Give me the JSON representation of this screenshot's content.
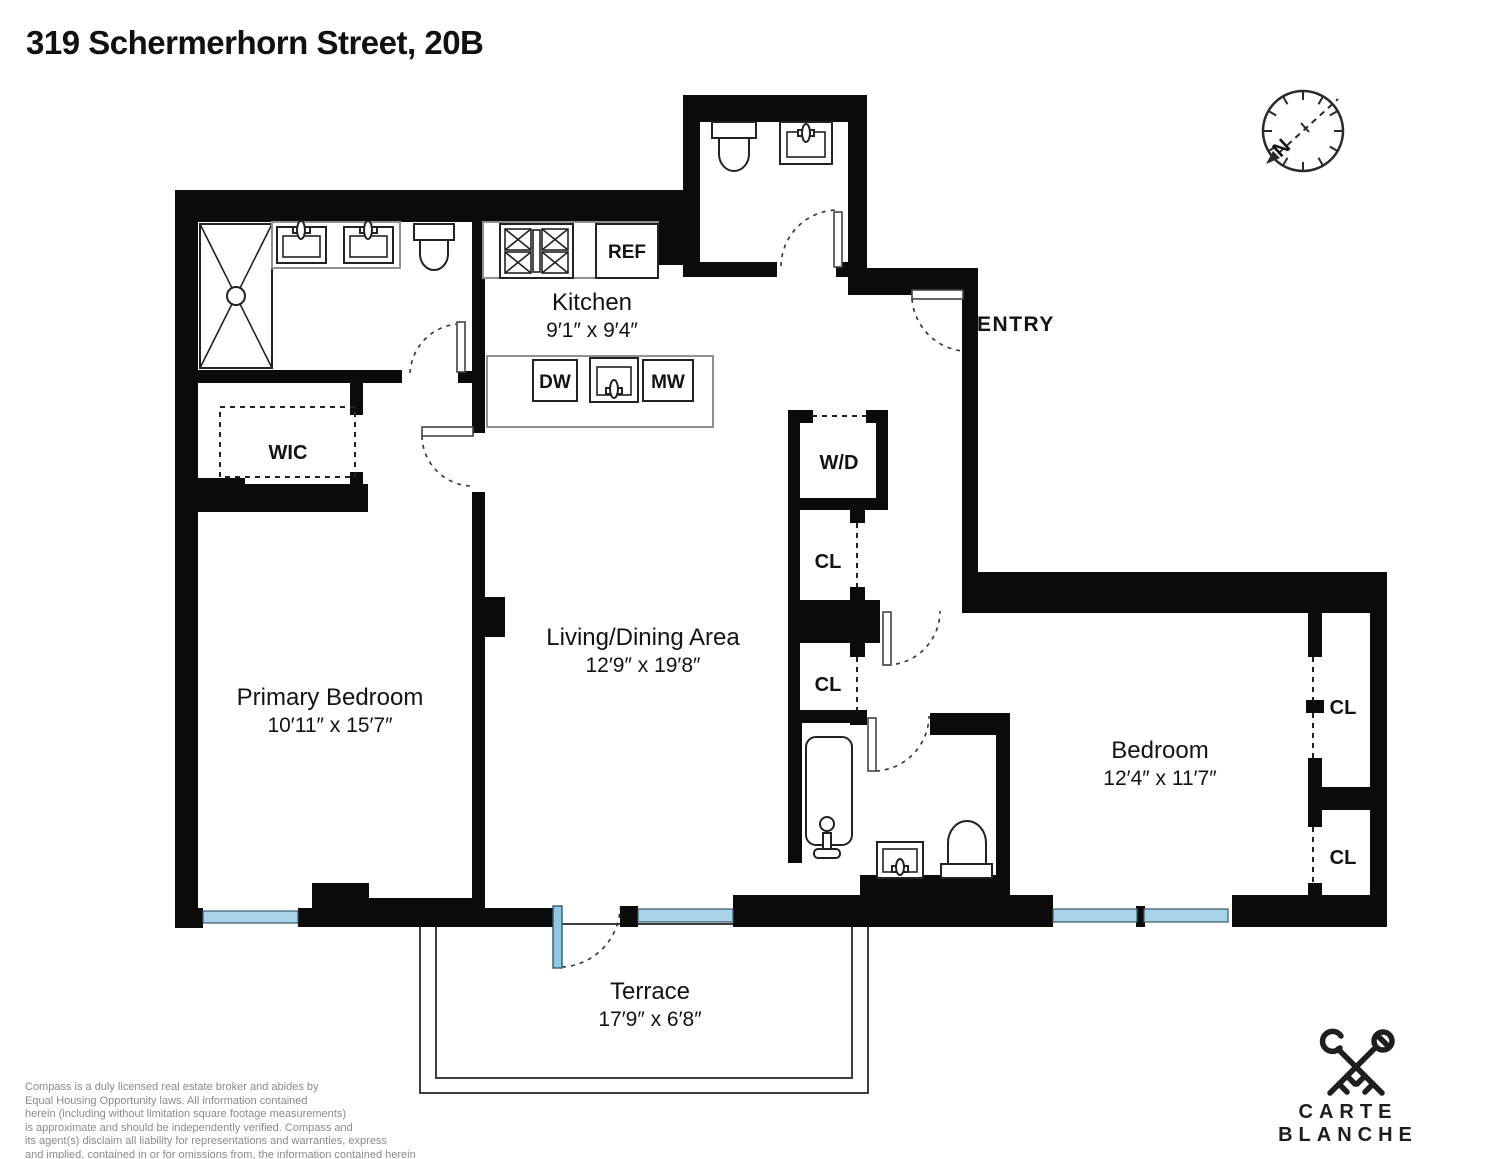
{
  "title": "319 Schermerhorn Street, 20B",
  "rooms": {
    "kitchen": {
      "name": "Kitchen",
      "dims": "9′1″ x 9′4″"
    },
    "living": {
      "name": "Living/Dining Area",
      "dims": "12′9″ x 19′8″"
    },
    "primary_bedroom": {
      "name": "Primary Bedroom",
      "dims": "10′11″ x 15′7″"
    },
    "bedroom": {
      "name": "Bedroom",
      "dims": "12′4″ x 11′7″"
    },
    "terrace": {
      "name": "Terrace",
      "dims": "17′9″ x 6′8″"
    },
    "entry": {
      "name": "ENTRY"
    },
    "wic": {
      "name": "WIC"
    },
    "washer_dryer": {
      "name": "W/D"
    }
  },
  "closets": [
    "CL",
    "CL",
    "CL",
    "CL"
  ],
  "appliances": {
    "refrigerator": "REF",
    "dishwasher": "DW",
    "microwave": "MW"
  },
  "compass": {
    "north": "N"
  },
  "brand": {
    "name": "CARTE BLANCHE"
  },
  "disclaimer": {
    "l1": "Compass is a duly licensed real estate broker and abides by",
    "l2": "Equal Housing Opportunity laws.  All information contained",
    "l3": "herein (including without limitation square footage measurements)",
    "l4": "is approximate and should be  independently verified. Compass and",
    "l5": "its agent(s) disclaim all liability for representations and warranties, express",
    "l6": "and implied, contained in or for omissions from, the information contained herein"
  },
  "colors": {
    "wall": "#0B0B0B",
    "window_blue": "#A9D4E8",
    "terrace_door_blue": "#8FC8E0",
    "label_text": "#131313",
    "muted_text": "#8A8A8A"
  }
}
